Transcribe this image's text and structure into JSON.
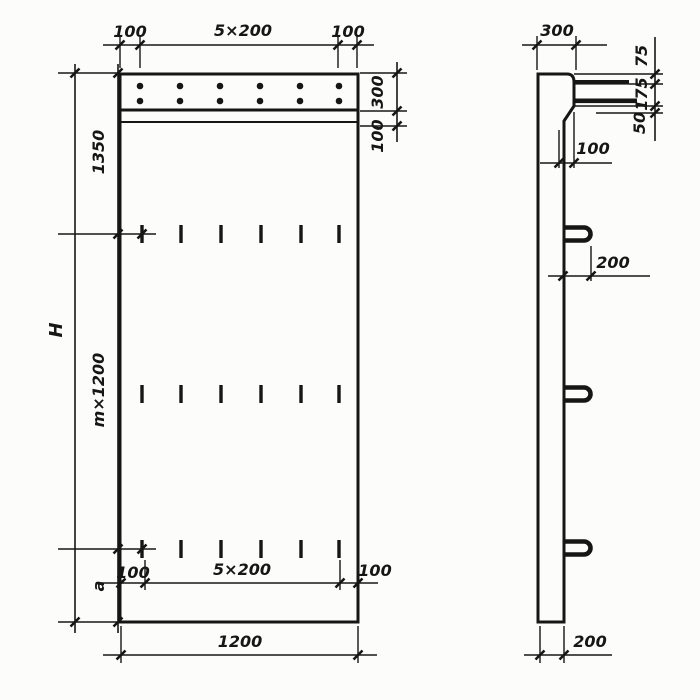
{
  "front_view": {
    "top": {
      "left": "100",
      "center": "5×200",
      "right": "100"
    },
    "right": {
      "band": "300",
      "ledge": "100"
    },
    "left": {
      "overall": "H",
      "top": "1350",
      "middle": "m×1200",
      "bottom": "a"
    },
    "bottom_inner": {
      "left": "100",
      "center": "5×200",
      "right": "100"
    },
    "bottom": {
      "overall": "1200"
    }
  },
  "side_view": {
    "top": "300",
    "right": {
      "seg1": "75",
      "seg2": "175",
      "seg3": "50"
    },
    "step": "100",
    "hook": "200",
    "bottom": "200"
  }
}
